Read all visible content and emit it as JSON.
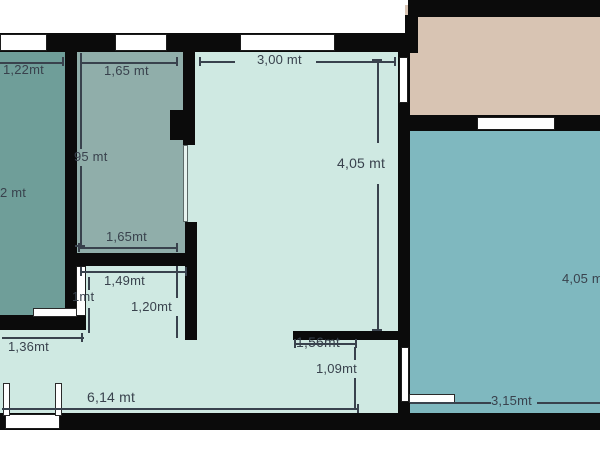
{
  "plan": {
    "title": "apartment-floor-plan",
    "unit": "mt",
    "colors": {
      "wall": "#0b0b0b",
      "room_teal": "#6f9e99",
      "room_gray": "#90aeaa",
      "room_mint": "#cfe9e2",
      "room_blue": "#7fb8bf",
      "room_beige": "#d8c4b3",
      "opening": "#ffffff",
      "dimension_line": "#39424d",
      "dimension_text": "#39424d"
    },
    "dimensions": {
      "top_left": "1,22mt",
      "top_gray": "1,65 mt",
      "top_mint": "3,00 mt",
      "mint_height": "4,05 mt",
      "gray_height": "95 mt",
      "teal_height": "2 mt",
      "gray_bottom": "1,65mt",
      "hall_width": "1,49mt",
      "hall_door": "1mt",
      "hall_inner": "1,20mt",
      "teal_bottom": "1,36mt",
      "bottom_width": "6,14 mt",
      "lower_mid": "1,56mt",
      "lower_mid_inner": "1,09mt",
      "blue_height": "4,05 mt",
      "blue_bottom": "3,15mt"
    }
  }
}
